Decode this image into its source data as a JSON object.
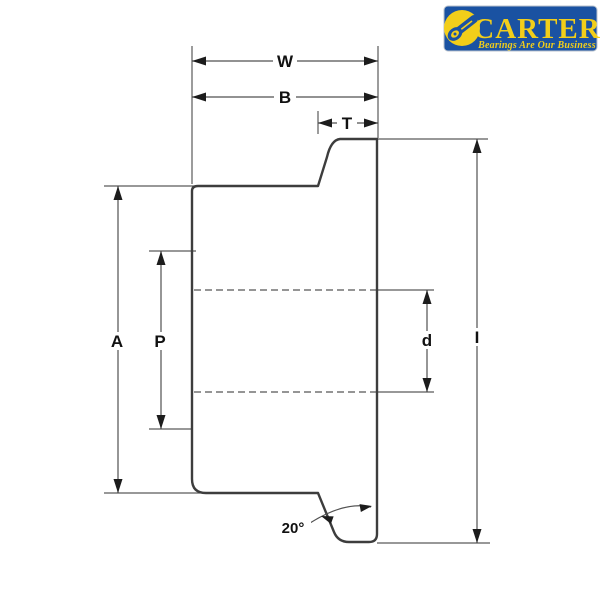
{
  "logo": {
    "brand": "CARTER",
    "tagline": "Bearings Are Our Business",
    "colors": {
      "blue": "#1a52a2",
      "yellow": "#f2ce1a",
      "border": "#b9c2cc"
    }
  },
  "diagram": {
    "line_color": "#3d3d3d",
    "labels": {
      "overall_width": "W",
      "body_width": "B",
      "flange_thickness": "T",
      "body_diameter": "A",
      "pilot_diameter": "P",
      "bore_diameter": "d",
      "flange_diameter": "I",
      "chamfer_angle": "20°"
    }
  }
}
